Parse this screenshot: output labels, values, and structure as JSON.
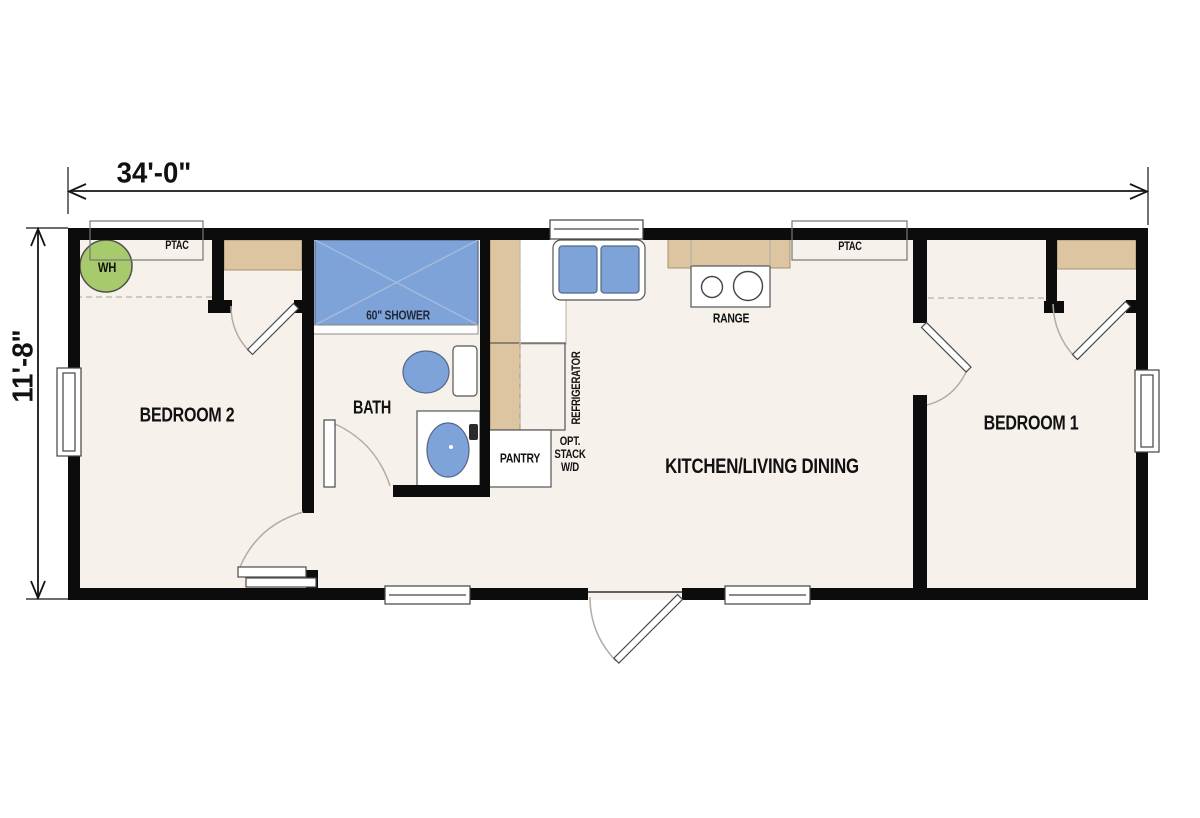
{
  "drawing": {
    "type": "manufactured-home floor plan",
    "dimensions": {
      "width_label": "34'-0\"",
      "height_label": "11'-8\""
    },
    "rooms": {
      "bedroom2": "BEDROOM 2",
      "bath": "BATH",
      "kitchen_living": "KITCHEN/LIVING DINING",
      "bedroom1": "BEDROOM 1"
    },
    "fixtures": {
      "shower": "60\" SHOWER",
      "range": "RANGE",
      "pantry": "PANTRY",
      "refrigerator": "REFRIGERATOR",
      "opt_stack_line1": "OPT.",
      "opt_stack_line2": "STACK",
      "opt_stack_line3": "W/D",
      "water_heater": "WH",
      "ptac_left": "PTAC",
      "ptac_right": "PTAC"
    },
    "colors": {
      "wall": "#0c0c0c",
      "floor": "#f6f1ea",
      "fixture_blue": "#7ea3d8",
      "fixture_blue_border": "#55688c",
      "counter_tan": "#dcc5a0",
      "counter_tan_border": "#a6946f",
      "water_heater_green": "#a7cb6c",
      "door_arc": "#b3aca1",
      "dashed_line": "#c5bcae",
      "outline": "#555555",
      "text": "#111111",
      "shower_text": "#202a3a"
    }
  }
}
